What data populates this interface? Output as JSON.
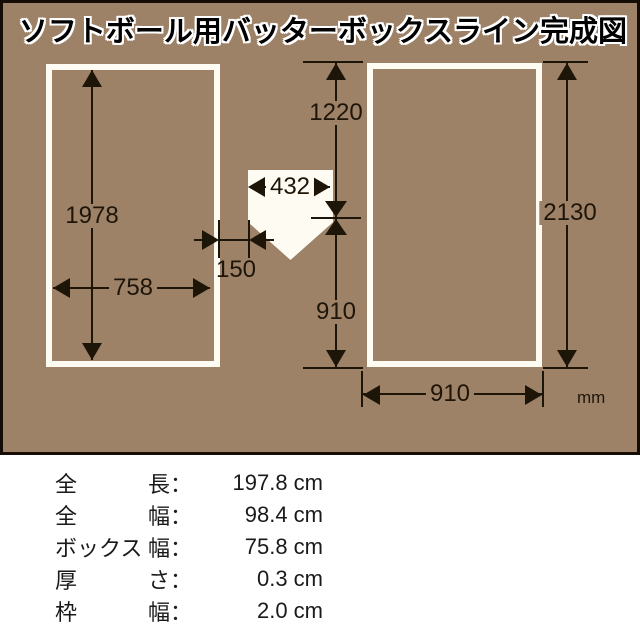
{
  "title": "ソフトボール用バッターボックスライン完成図",
  "diagram": {
    "unit_label": "mm",
    "dimensions": {
      "left_box_length": "1978",
      "left_box_width": "758",
      "plate_gap": "150",
      "plate_width": "432",
      "upper_span": "1220",
      "lower_span": "910",
      "right_box_length": "2130",
      "right_box_width": "910"
    }
  },
  "spec_table": {
    "rows": [
      {
        "item": "全",
        "attr": "長：",
        "value": "197.8 cm"
      },
      {
        "item": "全",
        "attr": "幅：",
        "value": "98.4 cm"
      },
      {
        "item": "ボックス",
        "attr": "幅：",
        "value": "75.8 cm"
      },
      {
        "item": "厚",
        "attr": "さ：",
        "value": "0.3 cm"
      },
      {
        "item": "枠",
        "attr": "幅：",
        "value": "2.0 cm"
      }
    ]
  },
  "colors": {
    "field_brown": "#9e8268",
    "frame_black": "#150d05",
    "line_white": "#fdfbf2",
    "ink": "#1e1509"
  }
}
